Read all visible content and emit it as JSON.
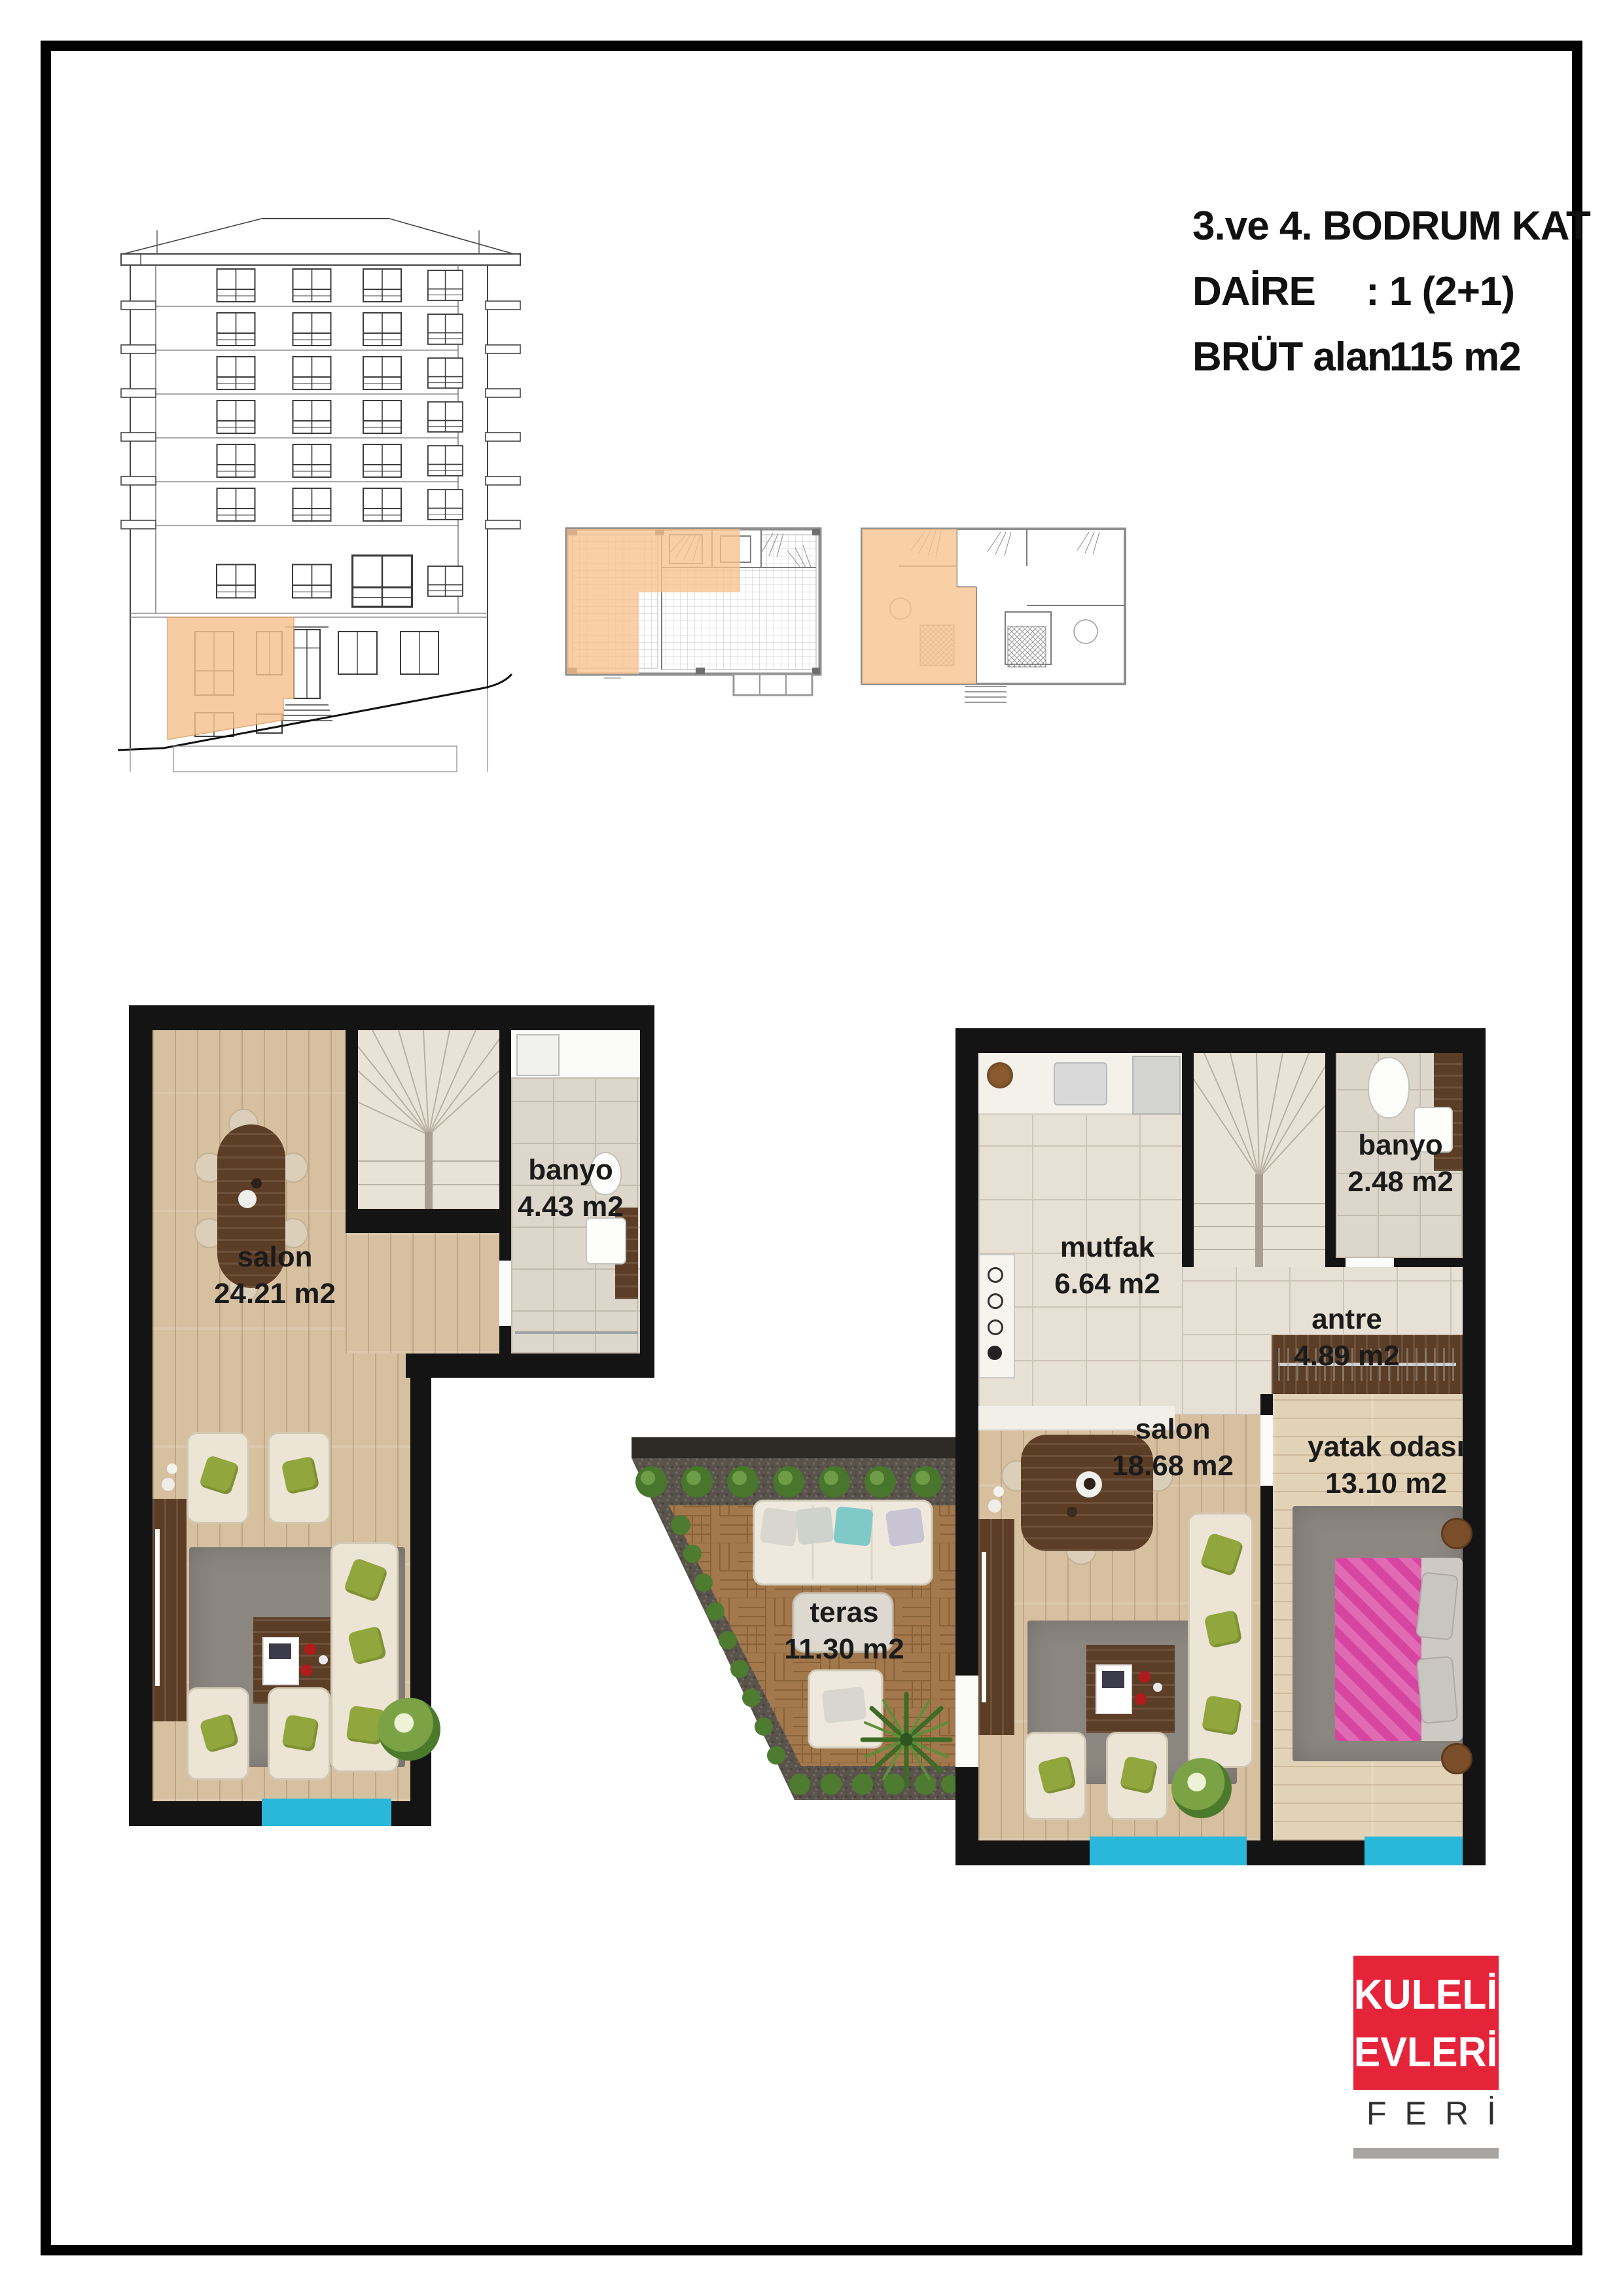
{
  "title": {
    "line1": "3.ve 4. BODRUM KAT",
    "daire_label": "DAİRE",
    "daire_value": ": 1 (2+1)",
    "brut_label": "BRÜT alan",
    "brut_value": ": 115 m2"
  },
  "plans": {
    "left": {
      "salon_name": "salon",
      "salon_area": "24.21 m2",
      "banyo_name": "banyo",
      "banyo_area": "4.43 m2"
    },
    "right": {
      "mutfak_name": "mutfak",
      "mutfak_area": "6.64 m2",
      "banyo_name": "banyo",
      "banyo_area": "2.48 m2",
      "antre_name": "antre",
      "antre_area": "4.89 m2",
      "salon_name": "salon",
      "salon_area": "18.68 m2",
      "yatak_name": "yatak odası",
      "yatak_area": "13.10 m2",
      "teras_name": "teras",
      "teras_area": "11.30 m2"
    }
  },
  "logo": {
    "line1": "KULELİ",
    "line2": "EVLERİ",
    "subtitle": "FERİ"
  },
  "colors": {
    "highlight_orange": "#F6C28E",
    "window_cyan": "#29B7DA",
    "logo_red": "#E5243A",
    "wall_black": "#141414"
  }
}
